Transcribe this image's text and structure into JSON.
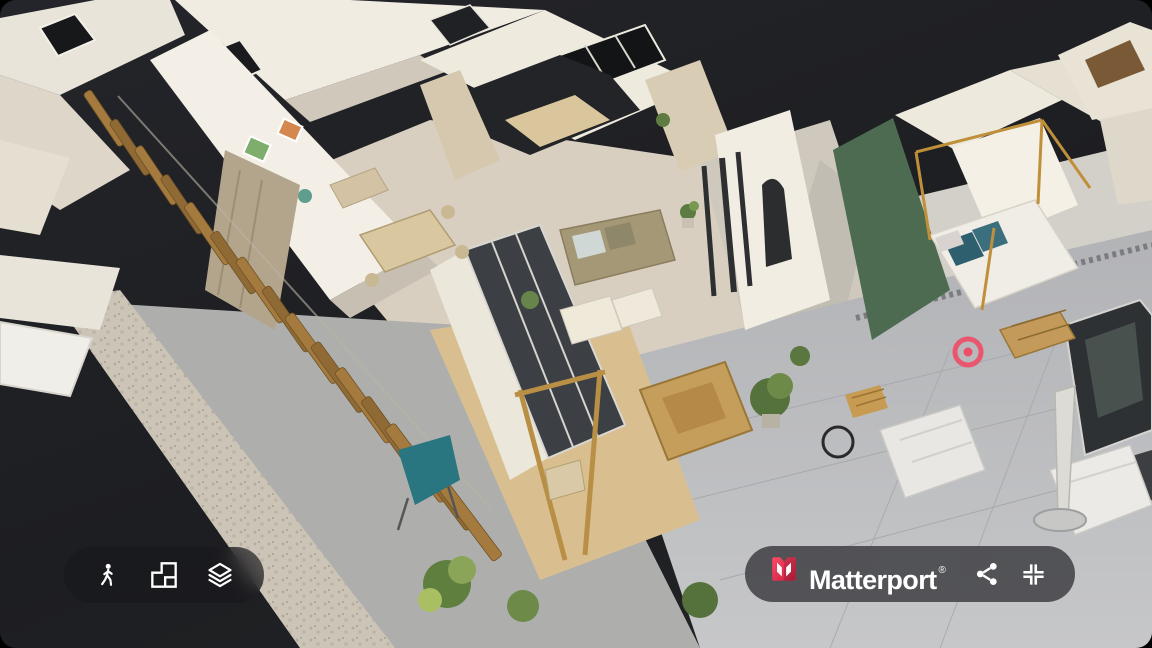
{
  "viewer": {
    "type": "matterport-3d-dollhouse-view",
    "background_color": "#1e1f22"
  },
  "scene": {
    "view_mode": "dollhouse",
    "scan_marker_color": "#ee4d66",
    "accent_wall_color": "#4d6b50"
  },
  "toolbar": {
    "buttons": [
      {
        "id": "walk-mode",
        "icon": "walk-person-icon"
      },
      {
        "id": "dollhouse-mode",
        "icon": "floorplan-icon"
      },
      {
        "id": "floor-selector",
        "icon": "layers-icon"
      }
    ]
  },
  "brandbar": {
    "logo_icon": "matterport-logo-icon",
    "brand_red": "#ff3a58",
    "brand_red_dark": "#c81c3f",
    "wordmark": "Matterport",
    "registered_mark": "®",
    "buttons": [
      {
        "id": "share",
        "icon": "share-icon"
      },
      {
        "id": "exit-fullscreen",
        "icon": "collapse-icon"
      }
    ]
  }
}
